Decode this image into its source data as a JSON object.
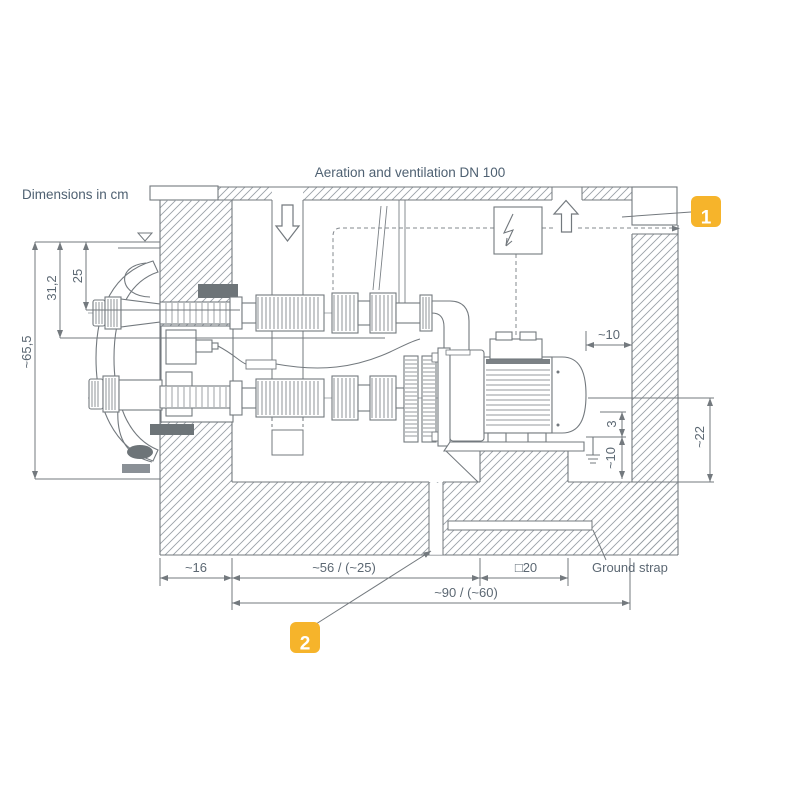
{
  "header": {
    "title": "Aeration and ventilation DN 100",
    "units_note": "Dimensions in cm"
  },
  "callouts": {
    "cover": "1",
    "drain": "2"
  },
  "labels": {
    "ground_strap": "Ground strap"
  },
  "dims": {
    "pool_depth": "~65,5",
    "inlet_depth_outer": "31,2",
    "inlet_depth": "25",
    "motor_wall_clearance": "~10",
    "base_height": "3",
    "pedestal_height": "~10",
    "axis_height": "~22",
    "wall_thickness": "~16",
    "hose_length": "~56 / (~25)",
    "pedestal_width": "□20",
    "chamber_width": "~90 / (~60)"
  },
  "colors": {
    "accent_yellow": "#F6B42B",
    "line_gray": "#73797E",
    "hatch_gray": "#9AA1A7",
    "text_gray": "#5C6873",
    "dark_part": "#6D7478"
  }
}
